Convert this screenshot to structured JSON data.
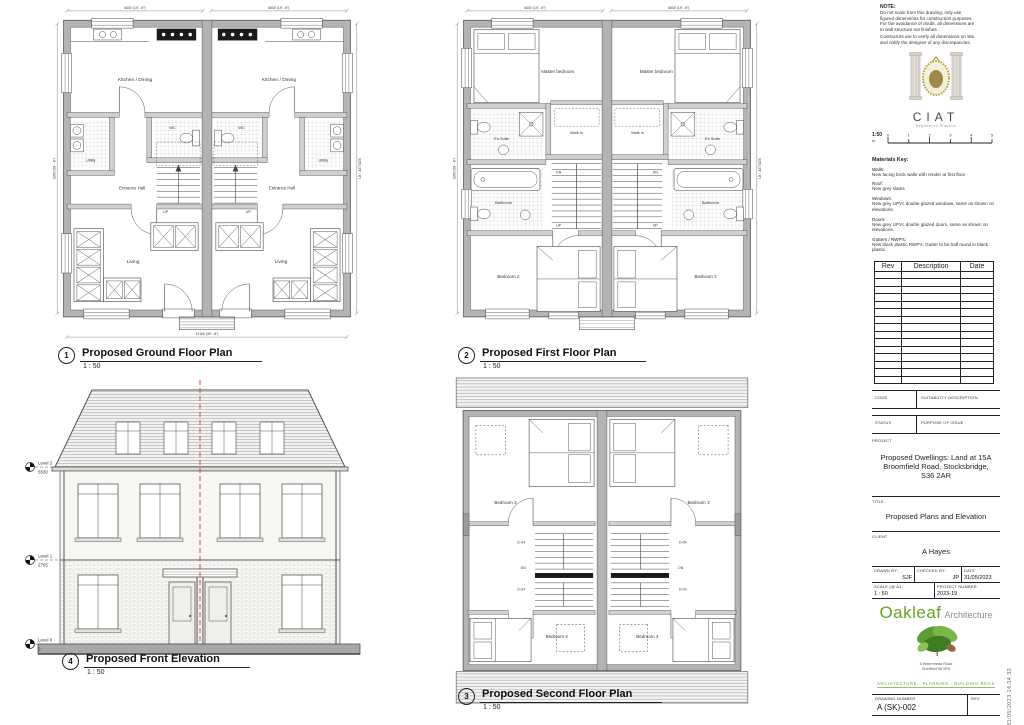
{
  "sheet": {
    "timestamp": "31/05/2023 14:34:32"
  },
  "drawings": {
    "ground": {
      "number": "1",
      "title": "Proposed Ground Floor Plan",
      "scale": "1 : 50",
      "rooms": {
        "kitchen": "Kitchen / Dining",
        "utility": "Utility",
        "wc": "WC",
        "hall": "Entrance Hall",
        "living": "Living",
        "up": "UP"
      }
    },
    "first": {
      "number": "2",
      "title": "Proposed First Floor Plan",
      "scale": "1 : 50",
      "rooms": {
        "master": "Master bedroom",
        "walkin": "Walk in",
        "ensuite": "En Suite",
        "bathroom": "Bathroom",
        "bedroom2": "Bedroom 2",
        "up": "UP",
        "dn": "DN"
      }
    },
    "second": {
      "number": "3",
      "title": "Proposed Second Floor Plan",
      "scale": "1 : 50",
      "rooms": {
        "bedroom3": "Bedroom 3",
        "bedroom4": "Bedroom 4",
        "dn": "DN",
        "d04": "D-04",
        "d03": "D-03"
      }
    },
    "elevation": {
      "number": "4",
      "title": "Proposed Front Elevation",
      "scale": "1 : 50",
      "levels": [
        {
          "label": "Level 2",
          "value": "5530"
        },
        {
          "label": "Level 1",
          "value": "2765"
        },
        {
          "label": "Level 0",
          "value": "0"
        }
      ]
    },
    "dims": {
      "unit_width": "6000 (19' - 8\")",
      "overall_width": "12100 (39' - 8\")",
      "depth": "9050 (29' - 8\")"
    }
  },
  "titleblock": {
    "note_title": "NOTE:",
    "note_lines": [
      "Do not scale from this drawing, only use",
      "figured dimensions for construction purposes.",
      "For the avoidance of doubt, all dimensions are",
      "to wall structure not finishes.",
      "Contractors are to verify all dimensions on site",
      "and notify the designer of any discrepancies."
    ],
    "ciat": {
      "name": "CIAT",
      "subtitle": "Registered Practice"
    },
    "scalebar": {
      "label": "1:50",
      "unit": "m",
      "ticks": [
        "0",
        "1",
        "2",
        "3",
        "4",
        "5"
      ]
    },
    "materials": {
      "title": "Materials Key:",
      "items": [
        {
          "name": "Walls:",
          "desc": "New facing brick walls with render at first floor"
        },
        {
          "name": "Roof:",
          "desc": "New grey slates"
        },
        {
          "name": "Windows:",
          "desc": "New grey UPVc double glazed windows, same as shown on elevations."
        },
        {
          "name": "Doors:",
          "desc": "New grey UPVc double glazed doors, same as shown on elevations."
        },
        {
          "name": "Gutters / RWP's:",
          "desc": "New black plastic RWP's, Gutter to be half round in black plastic"
        }
      ]
    },
    "rev_table": {
      "headers": [
        "Rev",
        "Description",
        "Date"
      ]
    },
    "code_row": {
      "label": "CODE",
      "value": "SUITABILITY DESCRIPTION"
    },
    "status_row": {
      "label": "STATUS",
      "value": "PURPOSE OF ISSUE"
    },
    "project": {
      "label": "PROJECT",
      "value": "Proposed Dwellings: Land at 15A Broomfield Road, Stocksbridge, S36 2AR"
    },
    "title_row": {
      "label": "TITLE",
      "value": "Proposed Plans and Elevation"
    },
    "client_row": {
      "label": "CLIENT",
      "value": "A Hayes"
    },
    "drawn": {
      "label": "DRAWN BY:",
      "value": "SJF"
    },
    "checked": {
      "label": "CHECKED BY:",
      "value": "JP"
    },
    "date": {
      "label": "DATE",
      "value": "31/05/2023"
    },
    "scale_row": {
      "label": "SCALE (@ A1:",
      "value": "1 : 50"
    },
    "project_number": {
      "label": "PROJECT NUMBER",
      "value": "2023-19"
    },
    "logo": {
      "name": "Oakleaf",
      "suffix": "Architecture",
      "address1": "6  Watermead Road",
      "address2": "Sheffield S6 5FA",
      "tagline": "ARCHITECTURE · PLANNING · BUILDING REGS"
    },
    "drawing_number": {
      "label": "DRAWING NUMBER",
      "value": "A (SK)-002"
    },
    "rev_label": "REV"
  }
}
